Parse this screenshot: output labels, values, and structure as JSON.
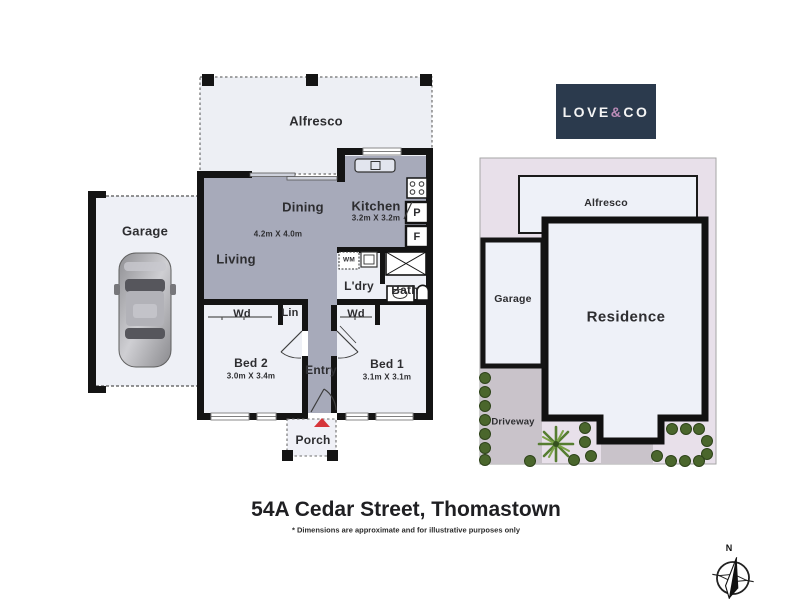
{
  "address": "54A Cedar Street, Thomastown",
  "disclaimer": "* Dimensions are approximate and for illustrative purposes only",
  "logo": {
    "love": "LOVE",
    "amp": "&",
    "co": "CO"
  },
  "floor_plan": {
    "alfresco": "Alfresco",
    "garage": "Garage",
    "dining": "Dining",
    "dining_dims": "4.2m X 4.0m",
    "kitchen": "Kitchen",
    "kitchen_dims": "3.2m X 3.2m",
    "living": "Living",
    "laundry": "L'dry",
    "bath": "Bath",
    "washing_machine": "WM",
    "wardrobe_bed2": "Wd",
    "linen": "Lin",
    "wardrobe_bed1": "Wd",
    "pantry": "P",
    "fridge": "F",
    "bed2": "Bed 2",
    "bed2_dims": "3.0m X 3.4m",
    "entry": "Entry",
    "bed1": "Bed 1",
    "bed1_dims": "3.1m X 3.1m",
    "porch": "Porch"
  },
  "site_plan": {
    "alfresco": "Alfresco",
    "garage": "Garage",
    "residence": "Residence",
    "driveway": "Driveway"
  },
  "compass": {
    "north": "N"
  },
  "colors": {
    "room_dark": "#a7aaba",
    "room_light": "#eef0f6",
    "wall": "#161616",
    "site_bg": "#e8e0ea",
    "driveway_gray": "#c9c3ca",
    "logo_navy": "#2b3a4d",
    "logo_pink": "#bd8cb8",
    "arrow_red": "#d6353a",
    "bush_green": "#4e6b2f"
  }
}
